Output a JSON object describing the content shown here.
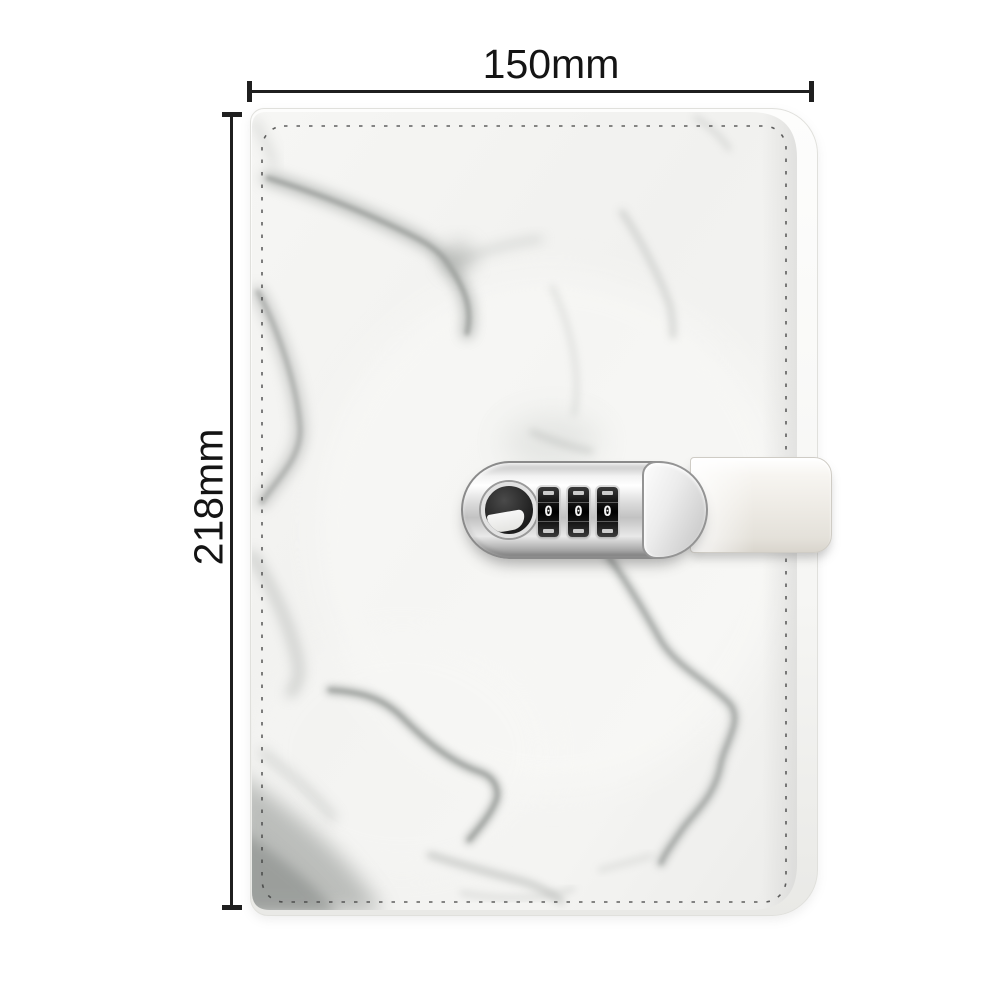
{
  "page": {
    "background_color": "#ffffff"
  },
  "annotations": {
    "width_label": "150mm",
    "height_label": "218mm",
    "line_color": "#1f1f1f",
    "text_color": "#141414"
  },
  "notebook": {
    "type": "marble-cover journal with combination-lock strap",
    "cover": {
      "base_color": "#f3f3f1",
      "vein_color": "#989c99",
      "stitch_color": "#3a3a3a"
    },
    "strap": {
      "color": "#efece7"
    },
    "lock": {
      "finish": "chrome",
      "dials": [
        "0",
        "0",
        "0"
      ]
    }
  }
}
